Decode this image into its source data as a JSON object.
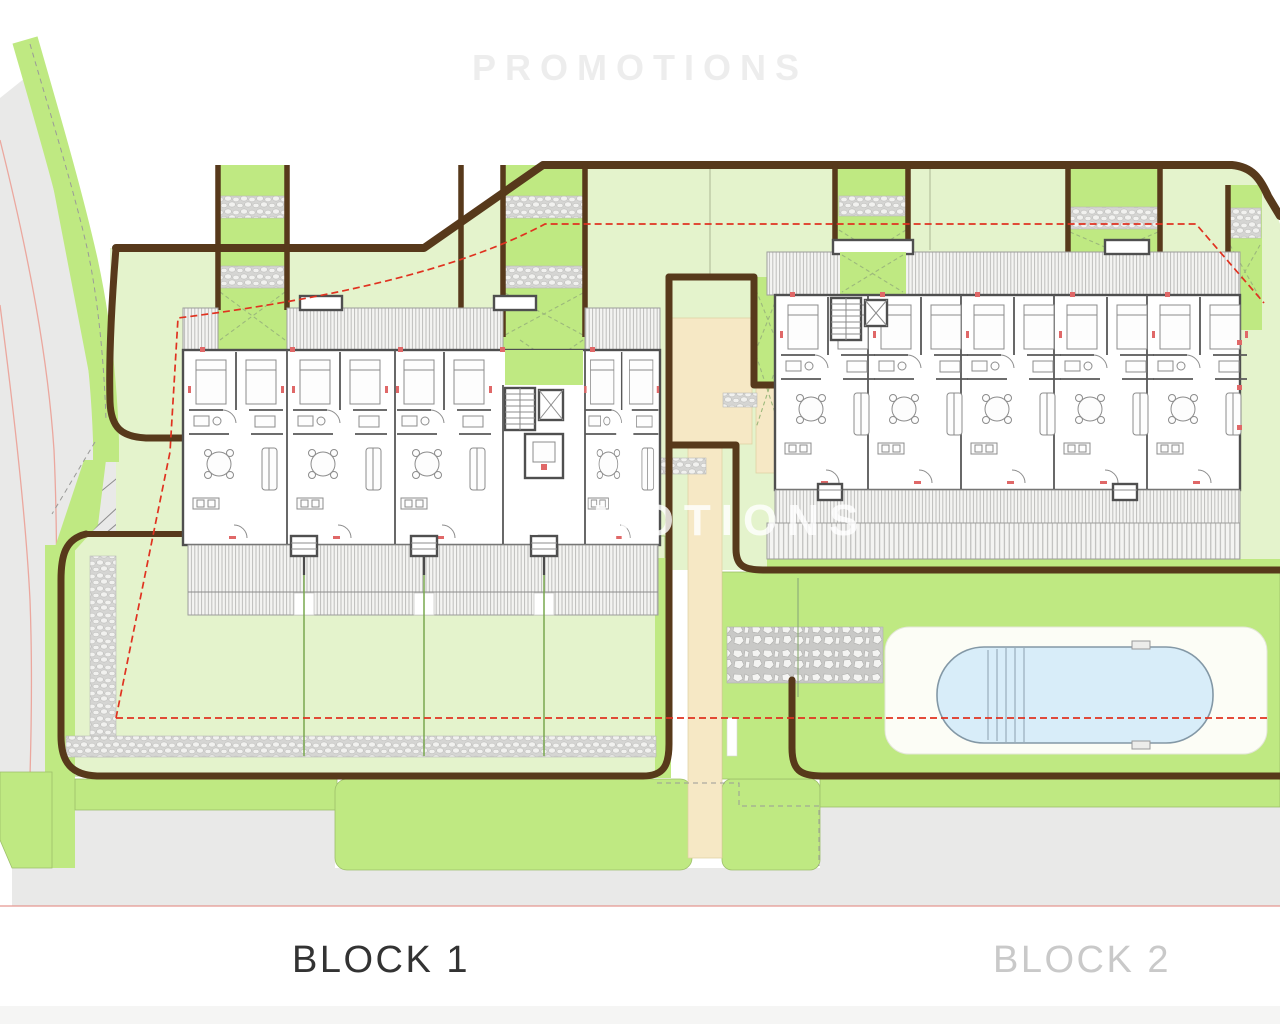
{
  "page": {
    "type": "architectural-site-plan"
  },
  "labels": {
    "block1": "BLOCK 1",
    "block2": "BLOCK 2"
  },
  "watermark": {
    "text": "PROMOTIONS"
  },
  "colors": {
    "lawn_light": "#e4f3cc",
    "lawn_bright": "#bfe982",
    "wall_brown": "#57391b",
    "path_beige": "#f6e8c5",
    "boundary_red": "#e03220",
    "pool_water": "#d8edf9",
    "road_gray": "#e9e9e8",
    "label_dark": "#333333",
    "label_light": "#c9c9c9"
  }
}
